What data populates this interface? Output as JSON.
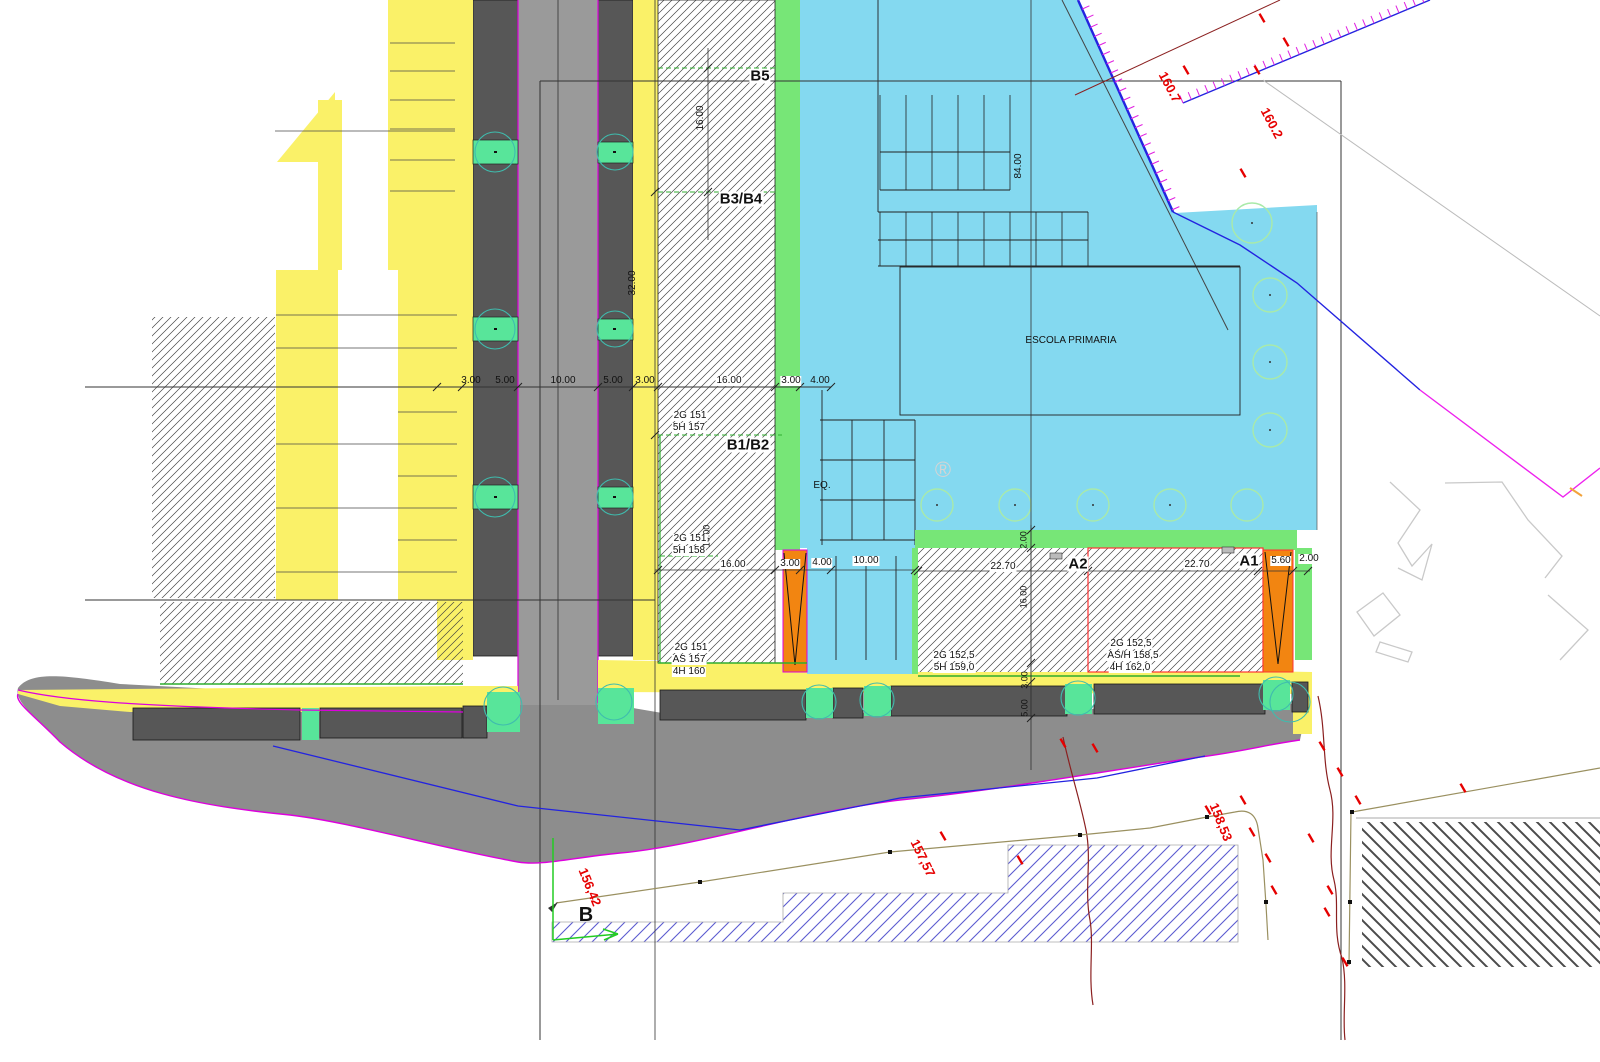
{
  "drawing": {
    "type": "urban-development-plan",
    "main_building_label": "ESCOLA PRIMARIA",
    "zone_labels": [
      "B5",
      "B3/B4",
      "B1/B2",
      "A1",
      "A2",
      "EQ."
    ],
    "survey_point_label": "B"
  },
  "colors": {
    "yellow": "#faf168",
    "road_dark": "#575757",
    "road_light": "#9a9a9a",
    "road_area": "#8d8d8d",
    "cyan": "#84d9f0",
    "green": "#77e677",
    "mint": "#58e59a",
    "orange": "#f28511",
    "magenta": "#dd00dd",
    "blue": "#2323e0",
    "olive": "#9a9060",
    "maroon": "#8b2020",
    "red_label": "#e60000",
    "teal": "#3fbcae",
    "light_green_circle": "#a9eaa9",
    "hatch_blue": "#5b5bd0",
    "red_boundary": "#ff3333",
    "green_dash": "#2fae2f"
  },
  "labels": [
    {
      "n": "zone-label-b5",
      "t": "B5",
      "x": 760,
      "y": 76,
      "s": 15,
      "b": 1,
      "bg": 1
    },
    {
      "n": "zone-label-b3b4",
      "t": "B3/B4",
      "x": 741,
      "y": 199,
      "s": 15,
      "b": 1,
      "bg": 1
    },
    {
      "n": "zone-label-b1b2",
      "t": "B1/B2",
      "x": 748,
      "y": 445,
      "s": 15,
      "b": 1,
      "bg": 1
    },
    {
      "n": "zone-label-a2",
      "t": "A2",
      "x": 1078,
      "y": 564,
      "s": 15,
      "b": 1,
      "bg": 1
    },
    {
      "n": "zone-label-a1",
      "t": "A1",
      "x": 1249,
      "y": 561,
      "s": 15,
      "b": 1,
      "bg": 1
    },
    {
      "n": "building-label-escola-primaria",
      "t": "ESCOLA PRIMARIA",
      "x": 1071,
      "y": 341,
      "s": 10
    },
    {
      "n": "zone-label-eq",
      "t": "EQ.",
      "x": 822,
      "y": 486,
      "s": 10
    },
    {
      "n": "survey-point-label-b",
      "t": "B",
      "x": 586,
      "y": 915,
      "s": 20,
      "b": 1
    },
    {
      "n": "dim-3-00-a",
      "t": "3.00",
      "x": 471,
      "y": 381,
      "s": 10
    },
    {
      "n": "dim-5-00-a",
      "t": "5.00",
      "x": 505,
      "y": 381,
      "s": 10
    },
    {
      "n": "dim-10-00-a",
      "t": "10.00",
      "x": 563,
      "y": 381,
      "s": 10
    },
    {
      "n": "dim-5-00-b",
      "t": "5.00",
      "x": 613,
      "y": 381,
      "s": 10
    },
    {
      "n": "dim-3-00-b",
      "t": "3.00",
      "x": 645,
      "y": 381,
      "s": 10
    },
    {
      "n": "dim-16-00-a",
      "t": "16.00",
      "x": 729,
      "y": 381,
      "s": 10,
      "bg": 1
    },
    {
      "n": "dim-3-00-c",
      "t": "3.00",
      "x": 791,
      "y": 381,
      "s": 10,
      "bg": 1
    },
    {
      "n": "dim-4-00-a",
      "t": "4.00",
      "x": 820,
      "y": 381,
      "s": 10
    },
    {
      "n": "dim-16-00-b",
      "t": "16.00",
      "x": 733,
      "y": 565,
      "s": 10,
      "bg": 1
    },
    {
      "n": "dim-3-00-d",
      "t": "3.00",
      "x": 790,
      "y": 564,
      "s": 10,
      "bg": 1
    },
    {
      "n": "dim-4-00-b",
      "t": "4.00",
      "x": 822,
      "y": 563,
      "s": 10,
      "bg": 1
    },
    {
      "n": "dim-10-00-b",
      "t": "10.00",
      "x": 866,
      "y": 561,
      "s": 10,
      "bg": 1
    },
    {
      "n": "dim-22-70-a",
      "t": "22.70",
      "x": 1003,
      "y": 567,
      "s": 10,
      "bg": 1
    },
    {
      "n": "dim-22-70-b",
      "t": "22.70",
      "x": 1197,
      "y": 565,
      "s": 10,
      "bg": 1
    },
    {
      "n": "dim-5-60",
      "t": "5.60",
      "x": 1281,
      "y": 561,
      "s": 10,
      "bg": 1
    },
    {
      "n": "dim-2-00-a",
      "t": "2.00",
      "x": 1309,
      "y": 559,
      "s": 10,
      "bg": 1
    },
    {
      "n": "dim-16-00-v1",
      "t": "16.00",
      "x": 701,
      "y": 118,
      "s": 10,
      "r": -90
    },
    {
      "n": "dim-32-00-v",
      "t": "32.00",
      "x": 633,
      "y": 283,
      "s": 10,
      "r": -90
    },
    {
      "n": "dim-84-00-v",
      "t": "84.00",
      "x": 1019,
      "y": 166,
      "s": 10,
      "r": -90
    },
    {
      "n": "dim-16-00-v2",
      "t": "16.00",
      "x": 707,
      "y": 536,
      "s": 9,
      "r": -90
    },
    {
      "n": "dim-2-00-v",
      "t": "2.00",
      "x": 1024,
      "y": 540,
      "s": 9,
      "r": -90
    },
    {
      "n": "dim-16-00-v3",
      "t": "16.00",
      "x": 1024,
      "y": 597,
      "s": 9,
      "r": -90
    },
    {
      "n": "dim-3-00-v",
      "t": "3.00",
      "x": 1025,
      "y": 680,
      "s": 9,
      "r": -90
    },
    {
      "n": "dim-5-00-v",
      "t": "5.00",
      "x": 1025,
      "y": 708,
      "s": 9,
      "r": -90
    },
    {
      "n": "note-b1b2-2g",
      "t": "2G 151",
      "x": 690,
      "y": 416,
      "s": 10,
      "bg": 1
    },
    {
      "n": "note-b1b2-5h",
      "t": "5H 157",
      "x": 689,
      "y": 428,
      "s": 10,
      "bg": 1
    },
    {
      "n": "note-b1-2g",
      "t": "2G 151",
      "x": 690,
      "y": 539,
      "s": 10,
      "bg": 1
    },
    {
      "n": "note-b1-5h",
      "t": "5H 158",
      "x": 689,
      "y": 551,
      "s": 10,
      "bg": 1
    },
    {
      "n": "note-b-low-2g",
      "t": "2G 151",
      "x": 691,
      "y": 648,
      "s": 10,
      "bg": 1
    },
    {
      "n": "note-b-low-as",
      "t": "AS 157",
      "x": 689,
      "y": 660,
      "s": 10,
      "bg": 1
    },
    {
      "n": "note-b-low-4h",
      "t": "4H 160",
      "x": 689,
      "y": 672,
      "s": 10,
      "bg": 1
    },
    {
      "n": "note-a2-2g",
      "t": "2G 152,5",
      "x": 954,
      "y": 656,
      "s": 10,
      "bg": 1
    },
    {
      "n": "note-a2-5h",
      "t": "5H 159,0",
      "x": 954,
      "y": 668,
      "s": 10,
      "bg": 1
    },
    {
      "n": "note-a1-2g",
      "t": "2G  152,5",
      "x": 1131,
      "y": 644,
      "s": 10,
      "bg": 1
    },
    {
      "n": "note-a1-ash",
      "t": "AS/H 158,5",
      "x": 1133,
      "y": 656,
      "s": 10,
      "bg": 1
    },
    {
      "n": "note-a1-4h",
      "t": "4H  162,0",
      "x": 1130,
      "y": 668,
      "s": 10,
      "bg": 1
    },
    {
      "n": "elev-160-7",
      "t": "160.7",
      "x": 1170,
      "y": 87,
      "s": 13,
      "b": 1,
      "r": 62,
      "c": "#e60000"
    },
    {
      "n": "elev-160-2",
      "t": "160.2",
      "x": 1272,
      "y": 123,
      "s": 13,
      "b": 1,
      "r": 62,
      "c": "#e60000"
    },
    {
      "n": "elev-156-42",
      "t": "156,42",
      "x": 590,
      "y": 887,
      "s": 13,
      "b": 1,
      "r": 68,
      "c": "#e60000"
    },
    {
      "n": "elev-157-57",
      "t": "157,57",
      "x": 923,
      "y": 858,
      "s": 13,
      "b": 1,
      "r": 64,
      "c": "#e60000"
    },
    {
      "n": "elev-158-53",
      "t": "158,53",
      "x": 1221,
      "y": 822,
      "s": 13,
      "b": 1,
      "r": 68,
      "c": "#e60000"
    },
    {
      "n": "watermark-registered",
      "t": "®",
      "x": 943,
      "y": 470,
      "s": 22,
      "c": "#d4d4d4"
    }
  ],
  "elevation_marks": [
    [
      1186,
      70
    ],
    [
      1257,
      70
    ],
    [
      1243,
      173
    ],
    [
      1262,
      18
    ],
    [
      1286,
      42
    ],
    [
      943,
      836
    ],
    [
      1020,
      860
    ],
    [
      1063,
      743
    ],
    [
      1095,
      748
    ],
    [
      1208,
      810
    ],
    [
      1243,
      800
    ],
    [
      1252,
      832
    ],
    [
      1268,
      858
    ],
    [
      1274,
      890
    ],
    [
      1322,
      746
    ],
    [
      1340,
      772
    ],
    [
      1330,
      890
    ],
    [
      1327,
      912
    ],
    [
      1345,
      962
    ],
    [
      1358,
      800
    ],
    [
      1463,
      788
    ],
    [
      1311,
      838
    ]
  ]
}
